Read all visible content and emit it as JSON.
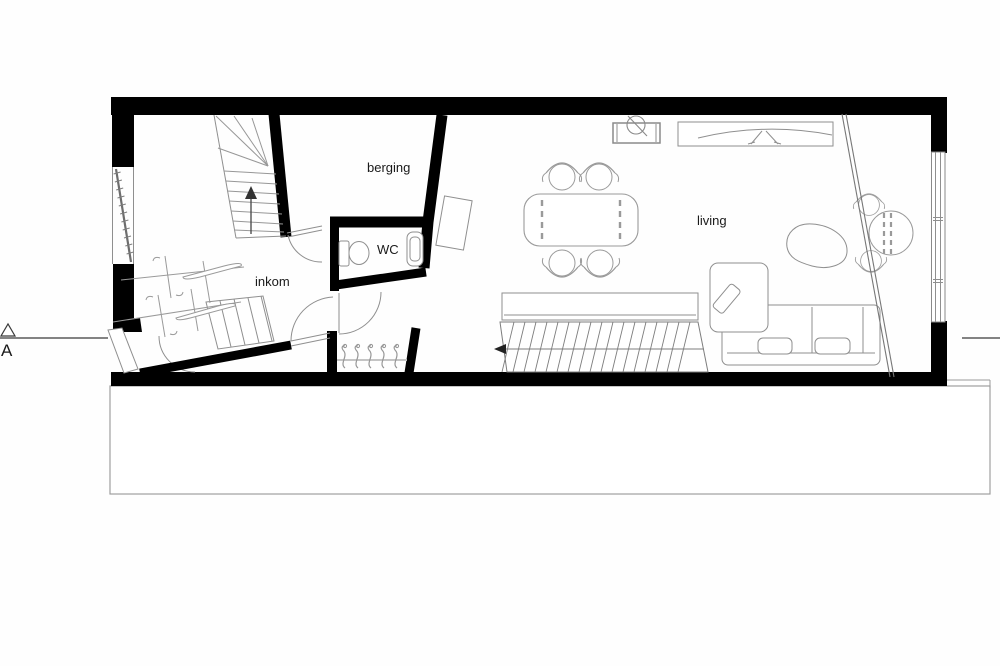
{
  "drawing": {
    "type": "architectural floor plan (ground floor)",
    "rooms": [
      {
        "id": "berging",
        "label": "berging"
      },
      {
        "id": "wc",
        "label": "WC"
      },
      {
        "id": "inkom",
        "label": "inkom"
      },
      {
        "id": "living",
        "label": "living"
      }
    ],
    "section_marker": {
      "label": "A"
    },
    "colors": {
      "wall": "#000000",
      "furniture_line": "#8f8f8f",
      "text": "#1a1a1a",
      "background": "#ffffff"
    },
    "elements": [
      "winder-staircase",
      "bicycles",
      "entrance-door",
      "storage-door",
      "wc-toilet",
      "wc-washbasin",
      "coat-hooks",
      "entry-steps",
      "desk",
      "dining-table-with-four-chairs",
      "kitchen-unit",
      "tv-cabinet",
      "area-rug",
      "corner-sofa",
      "bench",
      "basement-staircase",
      "glass-partition",
      "bistro-set",
      "window-right",
      "window-left",
      "terrace-outline"
    ]
  }
}
